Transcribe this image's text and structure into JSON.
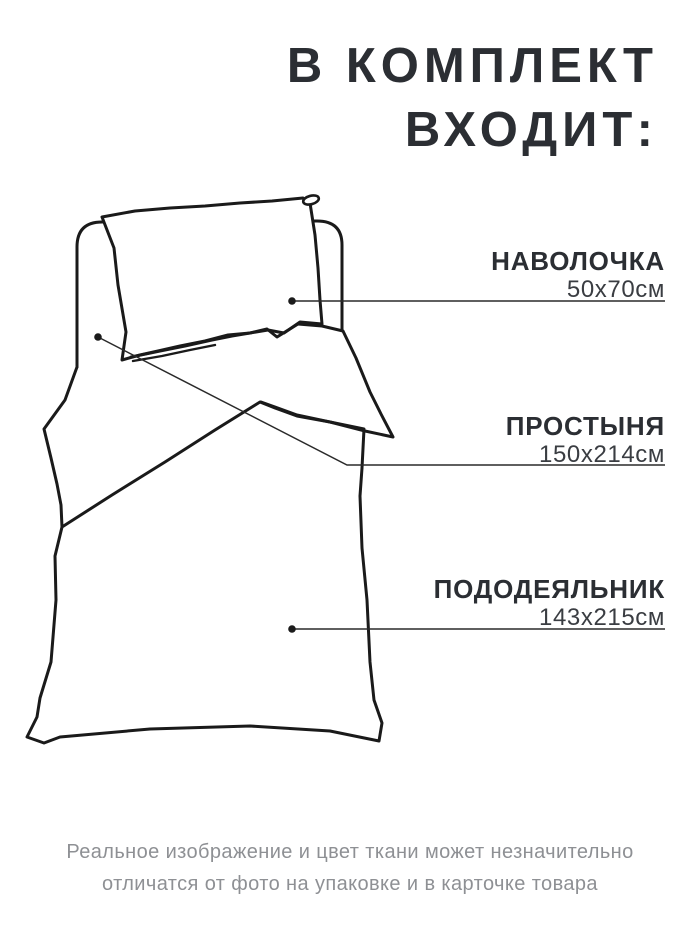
{
  "title": {
    "line1": "В КОМПЛЕКТ",
    "line2": "ВХОДИТ:"
  },
  "callouts": [
    {
      "name": "НАВОЛОЧКА",
      "size": "50х70см"
    },
    {
      "name": "ПРОСТЫНЯ",
      "size": "150х214см"
    },
    {
      "name": "ПОДОДЕЯЛЬНИК",
      "size": "143х215см"
    }
  ],
  "disclaimer": {
    "line1": "Реальное изображение и цвет ткани может незначительно",
    "line2": "отличатся от фото на упаковке и в карточке товара"
  },
  "colors": {
    "background": "#ffffff",
    "drawing_line": "#1a1a1a",
    "leader_line": "#2a2a2a",
    "title_text": "#2b2e33",
    "size_text": "#3a3d42",
    "disclaimer_text": "#8e9094"
  }
}
